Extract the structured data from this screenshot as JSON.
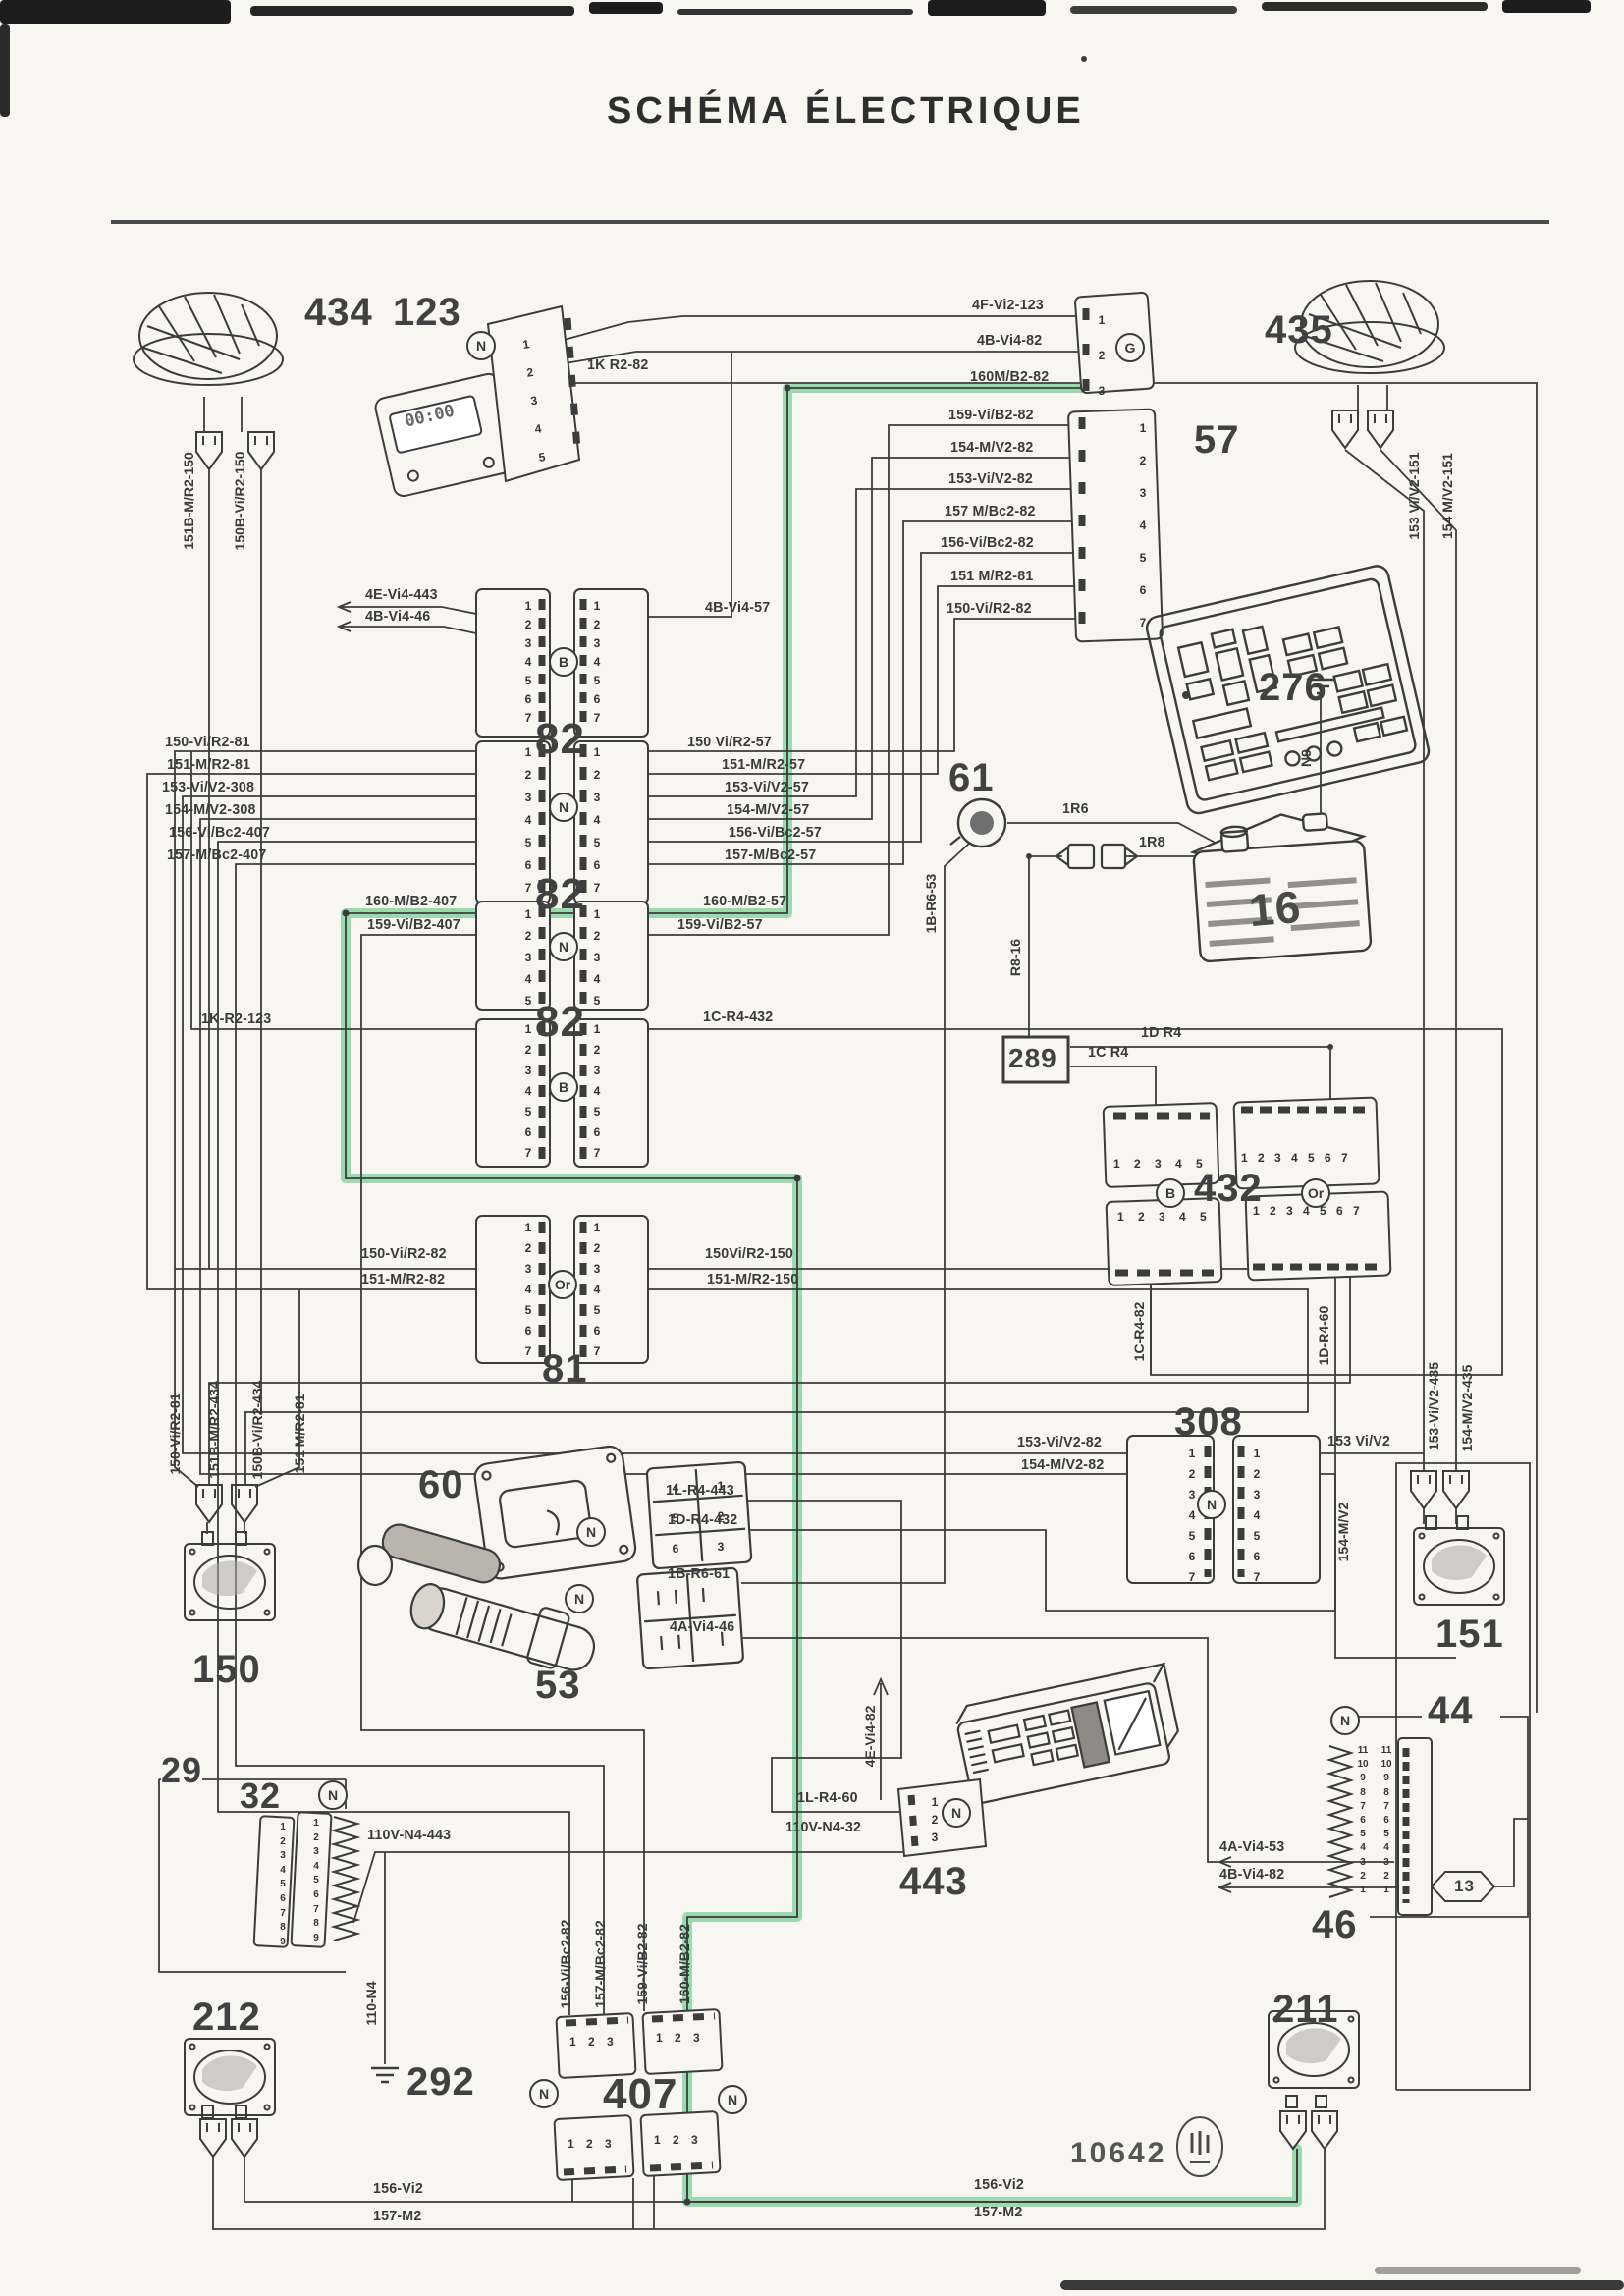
{
  "title": "SCHÉMA ÉLECTRIQUE",
  "display": {
    "clock": "00:00"
  },
  "letters": {
    "n": "N",
    "b": "B",
    "g": "G",
    "or": "Or"
  },
  "pins": {
    "v7": "1\n2\n3\n4\n5\n6\n7",
    "v5": "1\n2\n3\n4\n5",
    "v3": "1\n2\n3",
    "v9": "1\n2\n3\n4\n5\n6\n7\n8\n9",
    "v11": "11\n10\n9\n8\n7\n6\n5\n4\n3\n2\n1",
    "h5": "1 2 3 4 5",
    "h7": "1 2 3 4 5 6 7",
    "h3": "1 2 3",
    "g60l": "4\n5\n6",
    "g60r": "1\n2\n3"
  },
  "comp": {
    "c434": "434",
    "c123": "123",
    "c435": "435",
    "c57": "57",
    "c82": "82",
    "c81": "81",
    "c276": "276",
    "c61": "61",
    "c16": "16",
    "c289": "289",
    "c432": "432",
    "c308": "308",
    "c60": "60",
    "c53": "53",
    "c150": "150",
    "c151": "151",
    "c29": "29",
    "c32": "32",
    "c212": "212",
    "c292": "292",
    "c211": "211",
    "c443": "443",
    "c44": "44",
    "c46": "46",
    "c13": "13",
    "c407": "407",
    "c10642": "10642"
  },
  "labels": {
    "fVi2": "4F-Vi2-123",
    "bVi4": "4B-Vi4-82",
    "m160": "160M/B2-82",
    "k1": "1K R2-82",
    "s434a": "151B-M/R2-150",
    "s434b": "150B-Vi/R2-150",
    "s435a": "153 Vi/V2-151",
    "s435b": "154 M/V2-151",
    "c57p1": "159-Vi/B2-82",
    "c57p2": "154-M/V2-82",
    "c57p3": "153-Vi/V2-82",
    "c57p4": "157 M/Bc2-82",
    "c57p5": "156-Vi/Bc2-82",
    "c57p6": "151 M/R2-81",
    "c57p7": "150-Vi/R2-82",
    "a_l1": "4E-Vi4-443",
    "a_l2": "4B-Vi4-46",
    "a_r2": "4B-Vi4-57",
    "b_l1": "150-Vi/R2-81",
    "b_l2": "151-M/R2-81",
    "b_l3": "153-Vi/V2-308",
    "b_l4": "154-M/V2-308",
    "b_l5": "156-Vi/Bc2-407",
    "b_l6": "157-M/Bc2-407",
    "b_r1": "150 Vi/R2-57",
    "b_r2": "151-M/R2-57",
    "b_r3": "153-Vi/V2-57",
    "b_r4": "154-M/V2-57",
    "b_r5": "156-Vi/Bc2-57",
    "b_r6": "157-M/Bc2-57",
    "c_l1": "160-M/B2-407",
    "c_l2": "159-Vi/B2-407",
    "c_r1": "160-M/B2-57",
    "c_r2": "159-Vi/B2-57",
    "d_l1": "1K-R2-123",
    "d_r1": "1C-R4-432",
    "e_l3": "150-Vi/R2-82",
    "e_l4": "151-M/R2-82",
    "e_r3": "150Vi/R2-150",
    "e_r4": "151-M/R2-150",
    "f1": "150-Vi/R2-81",
    "f2": "151B-M/R2-434",
    "f3": "150B-Vi/R2-434",
    "f4": "151 M/R2-81",
    "r6": "1R6",
    "r8": "1R8",
    "n9": "N9",
    "b53": "1B-R6-53",
    "r816": "R8-16",
    "k289a": "1D R4",
    "k289b": "1C R4",
    "k432a": "1C-R4-82",
    "k432b": "1D-R4-60",
    "g_l1": "153-Vi/V2-82",
    "g_l2": "154-M/V2-82",
    "g_r1": "153 Vi/V2",
    "g_r2": "154-M/V2",
    "s151a": "153-Vi/V2-435",
    "s151b": "154-M/V2-435",
    "h60a": "1L-R4-443",
    "h60b": "1D-R4-432",
    "h53a": "1B-R6-61",
    "h53b": "4A-Vi4-46",
    "h443a": "1L-R4-60",
    "h443b": "110V-N4-32",
    "h443c": "4E-Vi4-82",
    "h32a": "110V-N4-443",
    "h32b": "110-N4",
    "h46a": "4A-Vi4-53",
    "h46b": "4B-Vi4-82",
    "q407a": "156-Vi/Bc2-82",
    "q407b": "157-M/Bc2-82",
    "q407c": "159-Vi/B2-82",
    "q407d": "160-M/B2-82",
    "vi2a": "156-Vi2",
    "vi2b": "156-Vi2",
    "m2a": "157-M2",
    "m2b": "157-M2"
  },
  "colors": {
    "ink": "#3c3c3c",
    "paper": "#f8f6f1",
    "highlight": "#8fd7a6"
  }
}
